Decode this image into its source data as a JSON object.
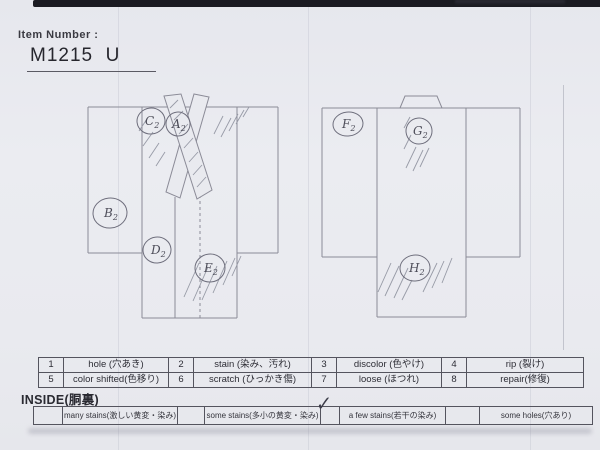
{
  "header": {
    "item_number_label": "Item Number :",
    "item_number_value": "M1215  U"
  },
  "condition_table": {
    "rows": [
      [
        {
          "num": "1",
          "label": "hole (穴あき)"
        },
        {
          "num": "2",
          "label": "stain (染み、汚れ)"
        },
        {
          "num": "3",
          "label": "discolor (色やけ)"
        },
        {
          "num": "4",
          "label": "rip (裂け)"
        }
      ],
      [
        {
          "num": "5",
          "label": "color shifted(色移り)"
        },
        {
          "num": "6",
          "label": "scratch (ひっかき傷)"
        },
        {
          "num": "7",
          "label": "loose (ほつれ)"
        },
        {
          "num": "8",
          "label": "repair(修復)"
        }
      ]
    ]
  },
  "inside": {
    "heading": "INSIDE(胴裏)",
    "check_glyph": "✓",
    "options": [
      {
        "checked": false,
        "label": "many stains(激しい黄変・染み)"
      },
      {
        "checked": false,
        "label": "some stains(多小の黄変・染み)"
      },
      {
        "checked": true,
        "label": "a few stains(若干の染み)"
      },
      {
        "checked": false,
        "label": "some holes(穴あり)"
      }
    ]
  },
  "diagram": {
    "front_view_markers": [
      {
        "letter": "C",
        "sub": "2",
        "x": 151,
        "y": 121,
        "rx": 14,
        "ry": 13
      },
      {
        "letter": "A",
        "sub": "2",
        "x": 178,
        "y": 124,
        "rx": 12,
        "ry": 12
      },
      {
        "letter": "B",
        "sub": "2",
        "x": 110,
        "y": 213,
        "rx": 17,
        "ry": 15
      },
      {
        "letter": "D",
        "sub": "2",
        "x": 157,
        "y": 250,
        "rx": 14,
        "ry": 13
      },
      {
        "letter": "E",
        "sub": "2",
        "x": 210,
        "y": 268,
        "rx": 15,
        "ry": 14
      }
    ],
    "back_view_markers": [
      {
        "letter": "F",
        "sub": "2",
        "x": 348,
        "y": 124,
        "rx": 15,
        "ry": 12
      },
      {
        "letter": "G",
        "sub": "2",
        "x": 419,
        "y": 131,
        "rx": 13,
        "ry": 13
      },
      {
        "letter": "H",
        "sub": "2",
        "x": 415,
        "y": 268,
        "rx": 15,
        "ry": 13
      }
    ]
  },
  "colors": {
    "paper": "#e9eaef",
    "pencil": "#8b8b97",
    "print": "#2d2d35",
    "top_bar": "#1b1b22"
  }
}
